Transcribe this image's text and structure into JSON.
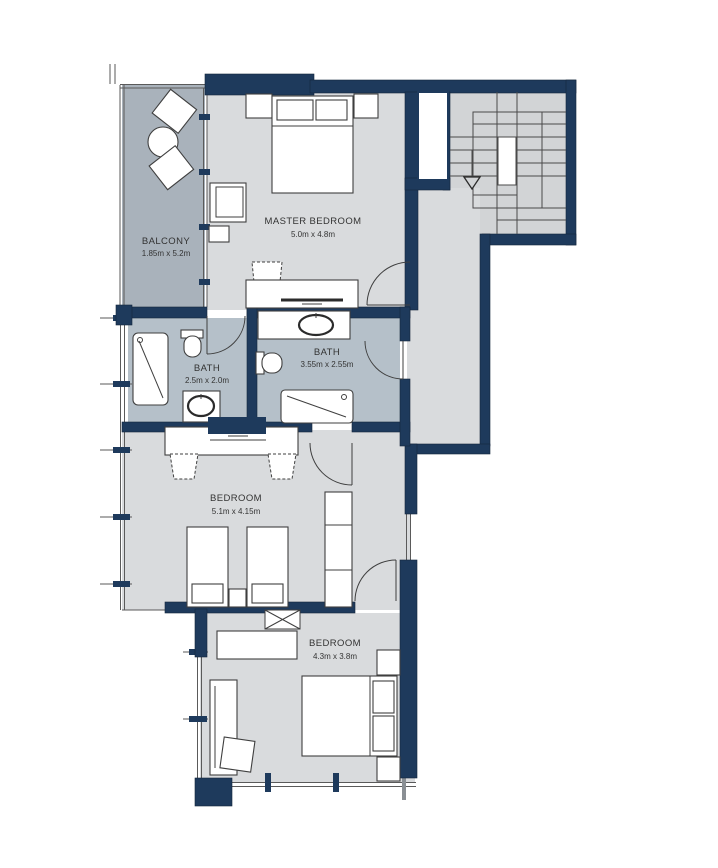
{
  "plan": {
    "type": "apartment-floor-plan",
    "rooms": [
      {
        "id": "balcony",
        "name": "BALCONY",
        "dims": "1.85m x 5.2m"
      },
      {
        "id": "master-bedroom",
        "name": "MASTER BEDROOM",
        "dims": "5.0m x 4.8m"
      },
      {
        "id": "bath-1",
        "name": "BATH",
        "dims": "2.5m x 2.0m"
      },
      {
        "id": "bath-2",
        "name": "BATH",
        "dims": "3.55m x 2.55m"
      },
      {
        "id": "bedroom-mid",
        "name": "BEDROOM",
        "dims": "5.1m x 4.15m"
      },
      {
        "id": "bedroom-bottom",
        "name": "BEDROOM",
        "dims": "4.3m x 3.8m"
      }
    ],
    "stairs": {
      "direction_arrow": "down"
    },
    "fixtures": [
      "double-bed",
      "twin-bed",
      "nightstand",
      "wardrobe",
      "desk",
      "chair",
      "armchair",
      "lounge-chair",
      "round-table",
      "bathtub",
      "shower-tub",
      "toilet",
      "sink",
      "tv",
      "staircase",
      "shelf"
    ],
    "colors": {
      "wall": "#1e3a5c",
      "room_floor": "#d9dbdd",
      "balcony_floor": "#a9b2bb",
      "bath_floor": "#b5c0c9",
      "stair_floor": "#d2d4d6",
      "furniture_line": "#3f3f3f",
      "label_text": "#333333",
      "background": "#ffffff"
    }
  }
}
